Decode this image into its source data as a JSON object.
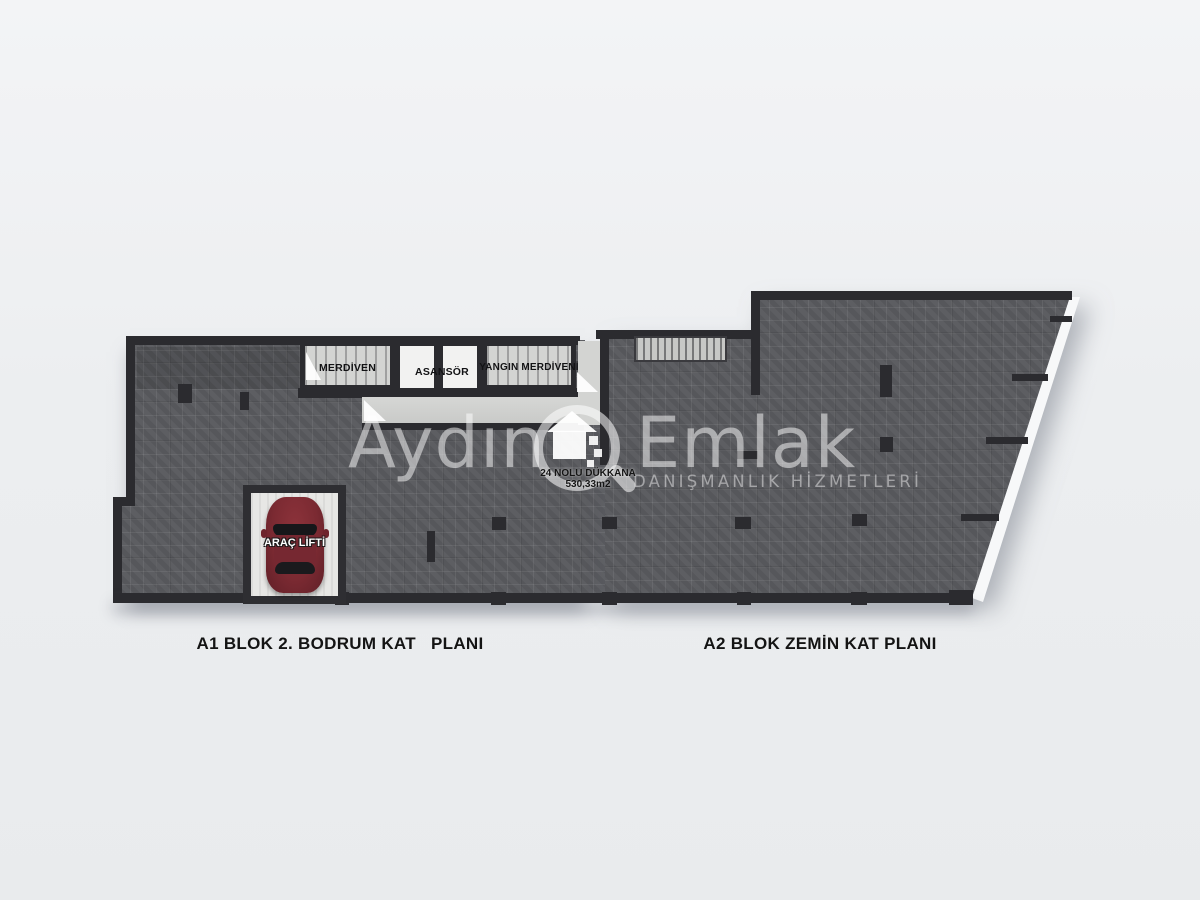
{
  "watermark": {
    "brand_first": "Aydın",
    "brand_second": "Emlak",
    "tagline": "DANIŞMANLIK HİZMETLERİ"
  },
  "rooms": {
    "stairs": "MERDİVEN",
    "elevator": "ASANSÖR",
    "fire_escape": "YANGIN MERDİVENİ",
    "car_lift": "ARAÇ LİFTİ"
  },
  "shop": {
    "name": "24 NOLU DÜKKANA",
    "area": "530,33m2"
  },
  "captions": {
    "left": "A1 BLOK 2. BODRUM KAT   PLANI",
    "right": "A2 BLOK ZEMİN KAT PLANI"
  },
  "colors": {
    "background": "#eceef0",
    "floor": "#595a5e",
    "wall": "#2b2b2f",
    "room_light": "#d3d4d2",
    "shaft_white": "#f2f2f1",
    "car_red": "#7b2a32"
  }
}
